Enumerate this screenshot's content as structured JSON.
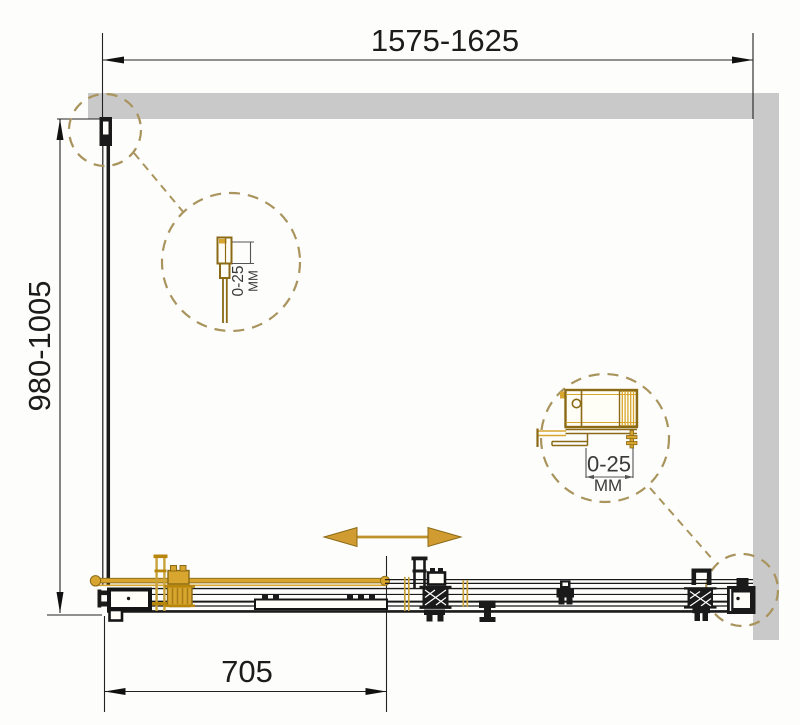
{
  "drawing": {
    "dimensions": {
      "width_range": "1575-1625",
      "depth_range": "980-1005",
      "door_offset": "705"
    },
    "details": [
      {
        "range": "0-25",
        "unit": "ММ"
      },
      {
        "range": "0-25",
        "unit": "ММ"
      }
    ],
    "colors": {
      "paper": "#fdfdfc",
      "wall": "#c9c9c9",
      "line": "#1a1a1a",
      "gold": "#d8a62f",
      "gold_dark": "#8a6a15",
      "dash_circle": "#a9945d",
      "arrow_gold": "#d09b31"
    }
  }
}
